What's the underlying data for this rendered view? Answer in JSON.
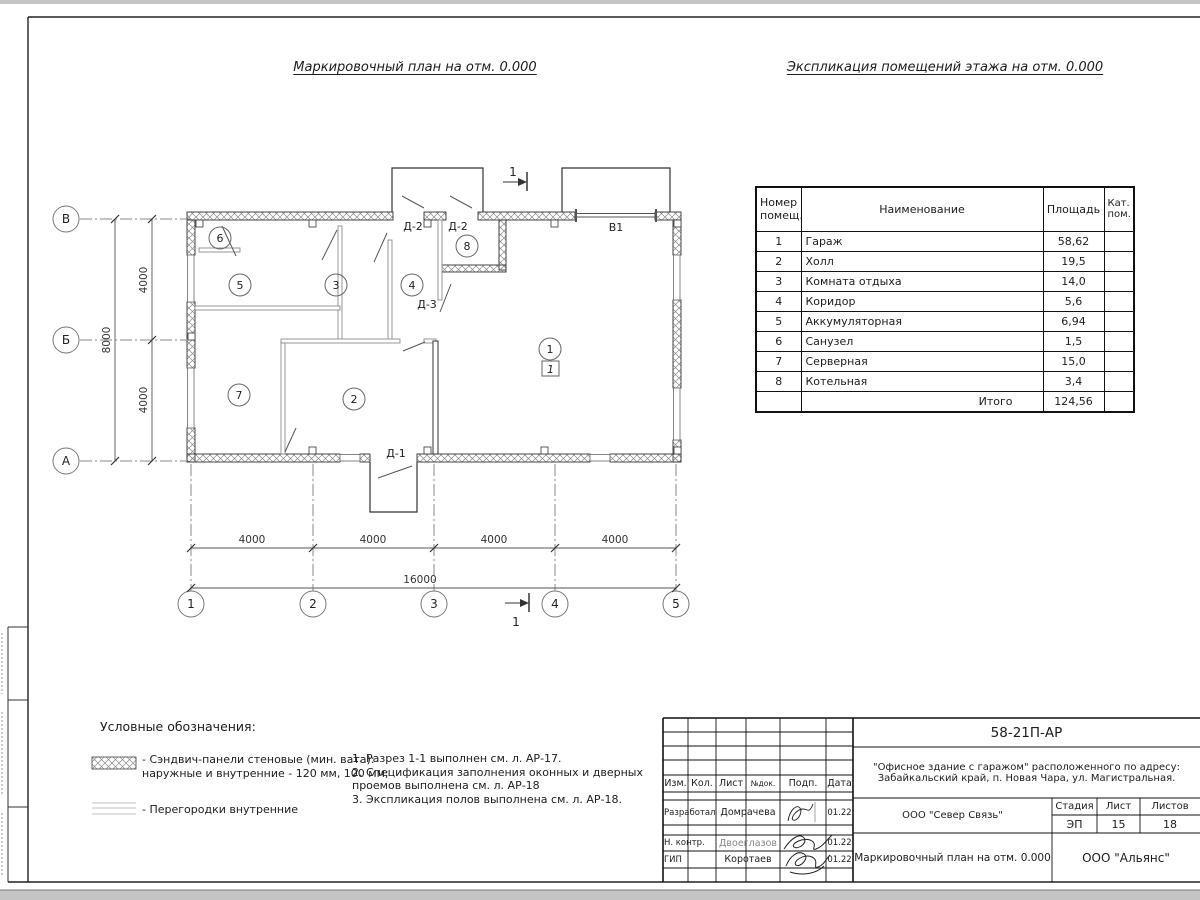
{
  "titles": {
    "plan": "Маркировочный план на отм. 0.000",
    "explication": "Экспликация помещений этажа на отм. 0.000"
  },
  "explication": {
    "headers": {
      "num_line1": "Номер",
      "num_line2": "помещ.",
      "name": "Наименование",
      "area": "Площадь",
      "cat_line1": "Кат.",
      "cat_line2": "пом."
    },
    "rows": [
      {
        "num": "1",
        "name": "Гараж",
        "area": "58,62",
        "cat": ""
      },
      {
        "num": "2",
        "name": "Холл",
        "area": "19,5",
        "cat": ""
      },
      {
        "num": "3",
        "name": "Комната отдыха",
        "area": "14,0",
        "cat": ""
      },
      {
        "num": "4",
        "name": "Коридор",
        "area": "5,6",
        "cat": ""
      },
      {
        "num": "5",
        "name": "Аккумуляторная",
        "area": "6,94",
        "cat": ""
      },
      {
        "num": "6",
        "name": "Санузел",
        "area": "1,5",
        "cat": ""
      },
      {
        "num": "7",
        "name": "Серверная",
        "area": "15,0",
        "cat": ""
      },
      {
        "num": "8",
        "name": "Котельная",
        "area": "3,4",
        "cat": ""
      }
    ],
    "total_label": "Итого",
    "total_area": "124,56"
  },
  "plan": {
    "axis_letters": [
      "В",
      "Б",
      "А"
    ],
    "axis_numbers": [
      "1",
      "2",
      "3",
      "4",
      "5"
    ],
    "rooms": [
      "1",
      "2",
      "3",
      "4",
      "5",
      "6",
      "7",
      "8"
    ],
    "garage_type_mark": "1",
    "section": "1",
    "doors": {
      "d1": "Д-1",
      "d2": "Д-2",
      "d3": "Д-3",
      "gate": "В1"
    },
    "dims": {
      "bottom": [
        "4000",
        "4000",
        "4000",
        "4000"
      ],
      "bottom_total": "16000",
      "left": [
        "4000",
        "4000"
      ],
      "left_total": "8000"
    }
  },
  "legend": {
    "title": "Условные обозначения:",
    "item1_line1": "- Сэндвич-панели стеновые (мин. вата):",
    "item1_line2": "наружные и внутренние - 120 мм, 100 мм;",
    "item2": "- Перегородки внутренние",
    "notes": [
      "1. Разрез 1-1 выполнен см. л. АР-17.",
      "2. Спецификация заполнения оконных и дверных",
      "проемов выполнена см. л. АР-18",
      "3. Экспликация полов выполнена см. л. АР-18."
    ]
  },
  "titleblock": {
    "doc_number": "58-21П-АР",
    "address_line1": "\"Офисное здание с гаражом\" расположенного по адресу:",
    "address_line2": "Забайкальский край, п. Новая Чара, ул. Магистральная.",
    "cols": {
      "izm": "Изм.",
      "kol": "Кол.",
      "list": "Лист",
      "ndok": "№док.",
      "podp": "Подп.",
      "data": "Дата"
    },
    "row1": {
      "role": "Разработал",
      "name": "Домрачева",
      "date": "01.22"
    },
    "row2": {
      "role": "Н. контр.",
      "name": "Двоеглазов",
      "date": "01.22"
    },
    "row3": {
      "role": "ГИП",
      "name": "Коротаев",
      "date": "01.22"
    },
    "org1": "ООО \"Север Связь\"",
    "stage": {
      "label": "Стадия",
      "value": "ЭП"
    },
    "sheet": {
      "label": "Лист",
      "value": "15"
    },
    "sheets": {
      "label": "Листов",
      "value": "18"
    },
    "doc_title": "Маркировочный план на отм. 0.000",
    "org2": "ООО \"Альянс\""
  }
}
